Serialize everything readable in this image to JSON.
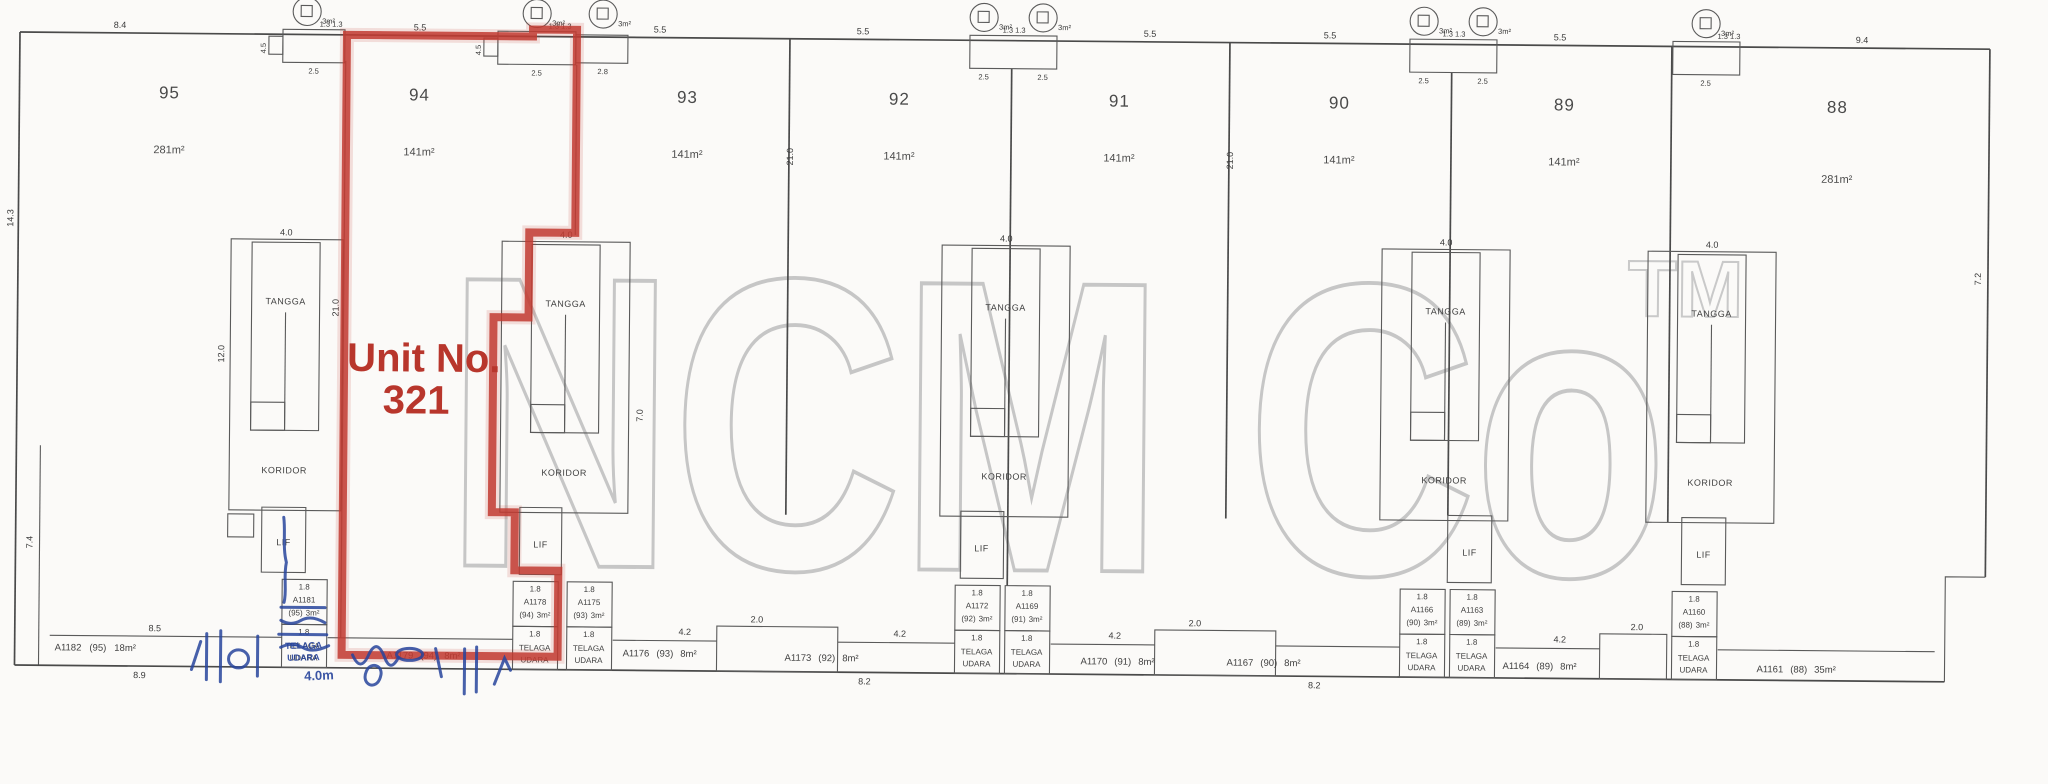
{
  "highlight": {
    "line1": "Unit No.",
    "line2": "321"
  },
  "watermark": {
    "text": "NCM Co",
    "tm": "TM"
  },
  "colors": {
    "highlight_red": "#c23b31",
    "ink_blue": "#27449c",
    "watermark_gray": "#c6c6c6",
    "line_gray": "#4a4a4a"
  },
  "units": [
    {
      "number": "95",
      "area": "281m²"
    },
    {
      "number": "94",
      "area": "141m²"
    },
    {
      "number": "93",
      "area": "141m²"
    },
    {
      "number": "92",
      "area": "141m²"
    },
    {
      "number": "91",
      "area": "141m²"
    },
    {
      "number": "90",
      "area": "141m²"
    },
    {
      "number": "89",
      "area": "141m²"
    },
    {
      "number": "88",
      "area": "281m²"
    }
  ],
  "core_labels": {
    "tangga": "TANGGA",
    "koridor": "KORIDOR",
    "lif": "LIF"
  },
  "shaft_labels": {
    "dim": "1.8",
    "telaga": "TELAGA",
    "udara": "UDARA"
  },
  "shafts": [
    {
      "id": "A1181",
      "unit": "(95)",
      "area": "3m²"
    },
    {
      "id": "A1178",
      "unit": "(94)",
      "area": "3m²"
    },
    {
      "id": "A1175",
      "unit": "(93)",
      "area": "3m²"
    },
    {
      "id": "A1172",
      "unit": "(92)",
      "area": "3m²"
    },
    {
      "id": "A1169",
      "unit": "(91)",
      "area": "3m²"
    },
    {
      "id": "A1166",
      "unit": "(90)",
      "area": "3m²"
    },
    {
      "id": "A1163",
      "unit": "(89)",
      "area": "3m²"
    },
    {
      "id": "A1160",
      "unit": "(88)",
      "area": "3m²"
    }
  ],
  "strip": [
    {
      "id": "A1182",
      "unit": "(95)",
      "area": "18m²"
    },
    {
      "id": "A1179",
      "unit": "(94)",
      "area": "8m²"
    },
    {
      "id": "A1176",
      "unit": "(93)",
      "area": "8m²"
    },
    {
      "id": "A1173",
      "unit": "(92)",
      "area": "8m²"
    },
    {
      "id": "A1170",
      "unit": "(91)",
      "area": "8m²"
    },
    {
      "id": "A1167",
      "unit": "(90)",
      "area": "8m²"
    },
    {
      "id": "A1164",
      "unit": "(89)",
      "area": "8m²"
    },
    {
      "id": "A1161",
      "unit": "(88)",
      "area": "35m²"
    }
  ],
  "dims": {
    "d84": "8.4",
    "d55": "5.5",
    "d94": "9.4",
    "d143": "14.3",
    "d74": "7.4",
    "d72": "7.2",
    "d25": "2.5",
    "d28": "2.8",
    "d13": "1.3  1.3",
    "d45": "4.5",
    "d40": "4.0",
    "d120": "12.0",
    "d210": "21.0",
    "d70": "7.0",
    "d42": "4.2",
    "d20": "2.0",
    "d85": "8.5",
    "d89": "8.9",
    "d82": "8.2",
    "d3m": "3m²"
  },
  "ink": {
    "note": "4.0m"
  }
}
